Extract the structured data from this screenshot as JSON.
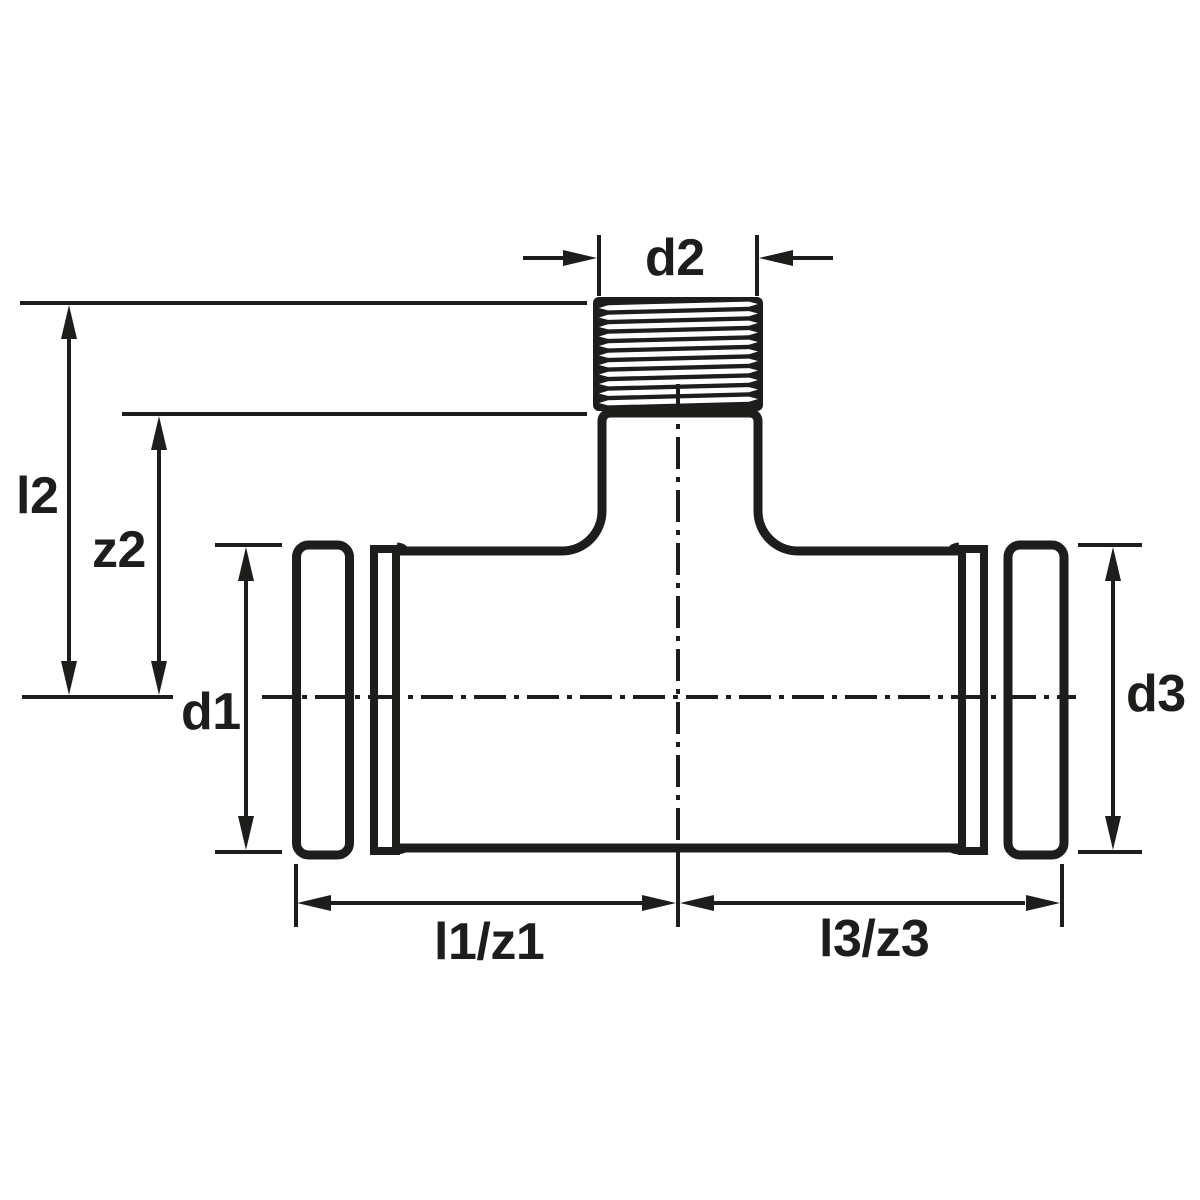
{
  "drawing": {
    "colors": {
      "line": "#1d1d1b",
      "background": "#ffffff"
    },
    "labels": {
      "d1": "d1",
      "d2": "d2",
      "d3": "d3",
      "l2": "l2",
      "z2": "z2",
      "l1z1": "l1/z1",
      "l3z3": "l3/z3"
    }
  }
}
